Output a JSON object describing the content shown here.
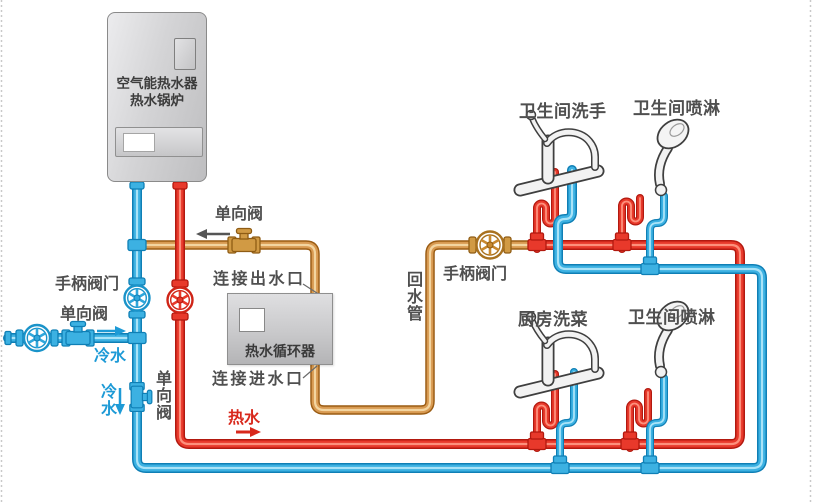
{
  "heater": {
    "name_line1": "空气能热水器",
    "name_line2": "热水锅炉"
  },
  "circulator": {
    "name": "热水循环器"
  },
  "labels": {
    "check_valve_top": "单向阀",
    "connect_outlet": "连接出水口",
    "connect_inlet": "连接进水口",
    "return_pipe": "回水管",
    "handle_valve_mid": "手柄阀门",
    "handle_valve_left": "手柄阀门",
    "check_valve_inlet": "单向阀",
    "cold_water": "冷水",
    "cold_water_drop": "冷水",
    "check_valve_drop": "单向阀",
    "hot_water": "热水",
    "fixture_bath_sink": "卫生间洗手",
    "fixture_bath_shower_top": "卫生间喷淋",
    "fixture_kitchen_sink": "厨房洗菜",
    "fixture_bath_shower_bottom": "卫生间喷淋"
  },
  "colors": {
    "hot_pipe": "#e8392b",
    "cold_pipe": "#3cb1e2",
    "return_pipe": "#d89a52",
    "hot_text": "#d8281c",
    "cold_text": "#1d9ad6",
    "label_text": "#4f4f4f"
  }
}
